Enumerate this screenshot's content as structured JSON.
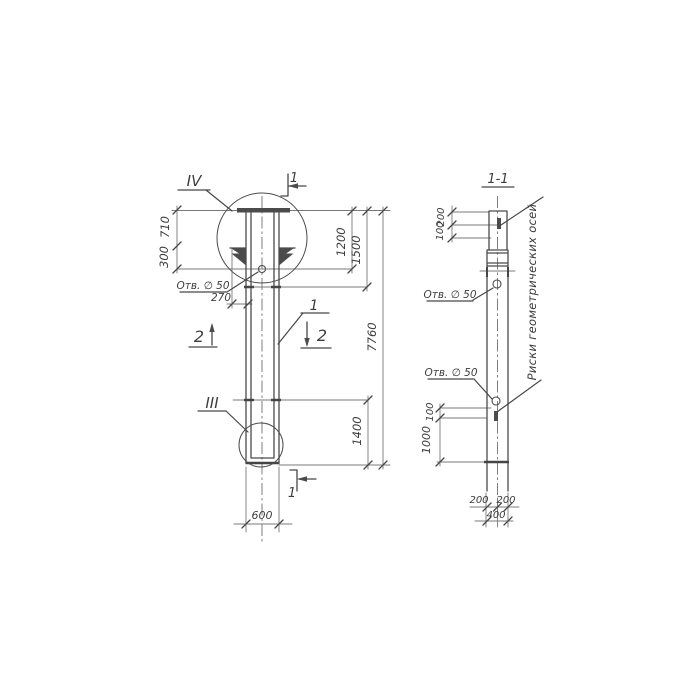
{
  "elevation": {
    "detail_top_label": "IV",
    "detail_bottom_label": "III",
    "part_label": "1",
    "section1_top_label": "1",
    "section1_bottom_label": "1",
    "section2_left_label": "2",
    "section2_right_label": "2",
    "hole_label": "Отв. ∅ 50",
    "dim_710": "710",
    "dim_300": "300",
    "dim_270": "270",
    "dim_1200": "1200",
    "dim_1500": "1500",
    "dim_7760": "7760",
    "dim_1400": "1400",
    "dim_600": "600"
  },
  "section": {
    "title": "1-1",
    "dim_200_top": "200",
    "dim_100_top": "100",
    "hole_label_upper": "Отв. ∅ 50",
    "hole_label_lower": "Отв. ∅ 50",
    "axes_note": "Риски геометрических осей",
    "dim_100_side": "100",
    "dim_1000": "1000",
    "dim_200_left": "200",
    "dim_200_right": "200",
    "dim_400": "400"
  },
  "colors": {
    "ink": "#4b4b4b",
    "paper": "#ffffff"
  }
}
